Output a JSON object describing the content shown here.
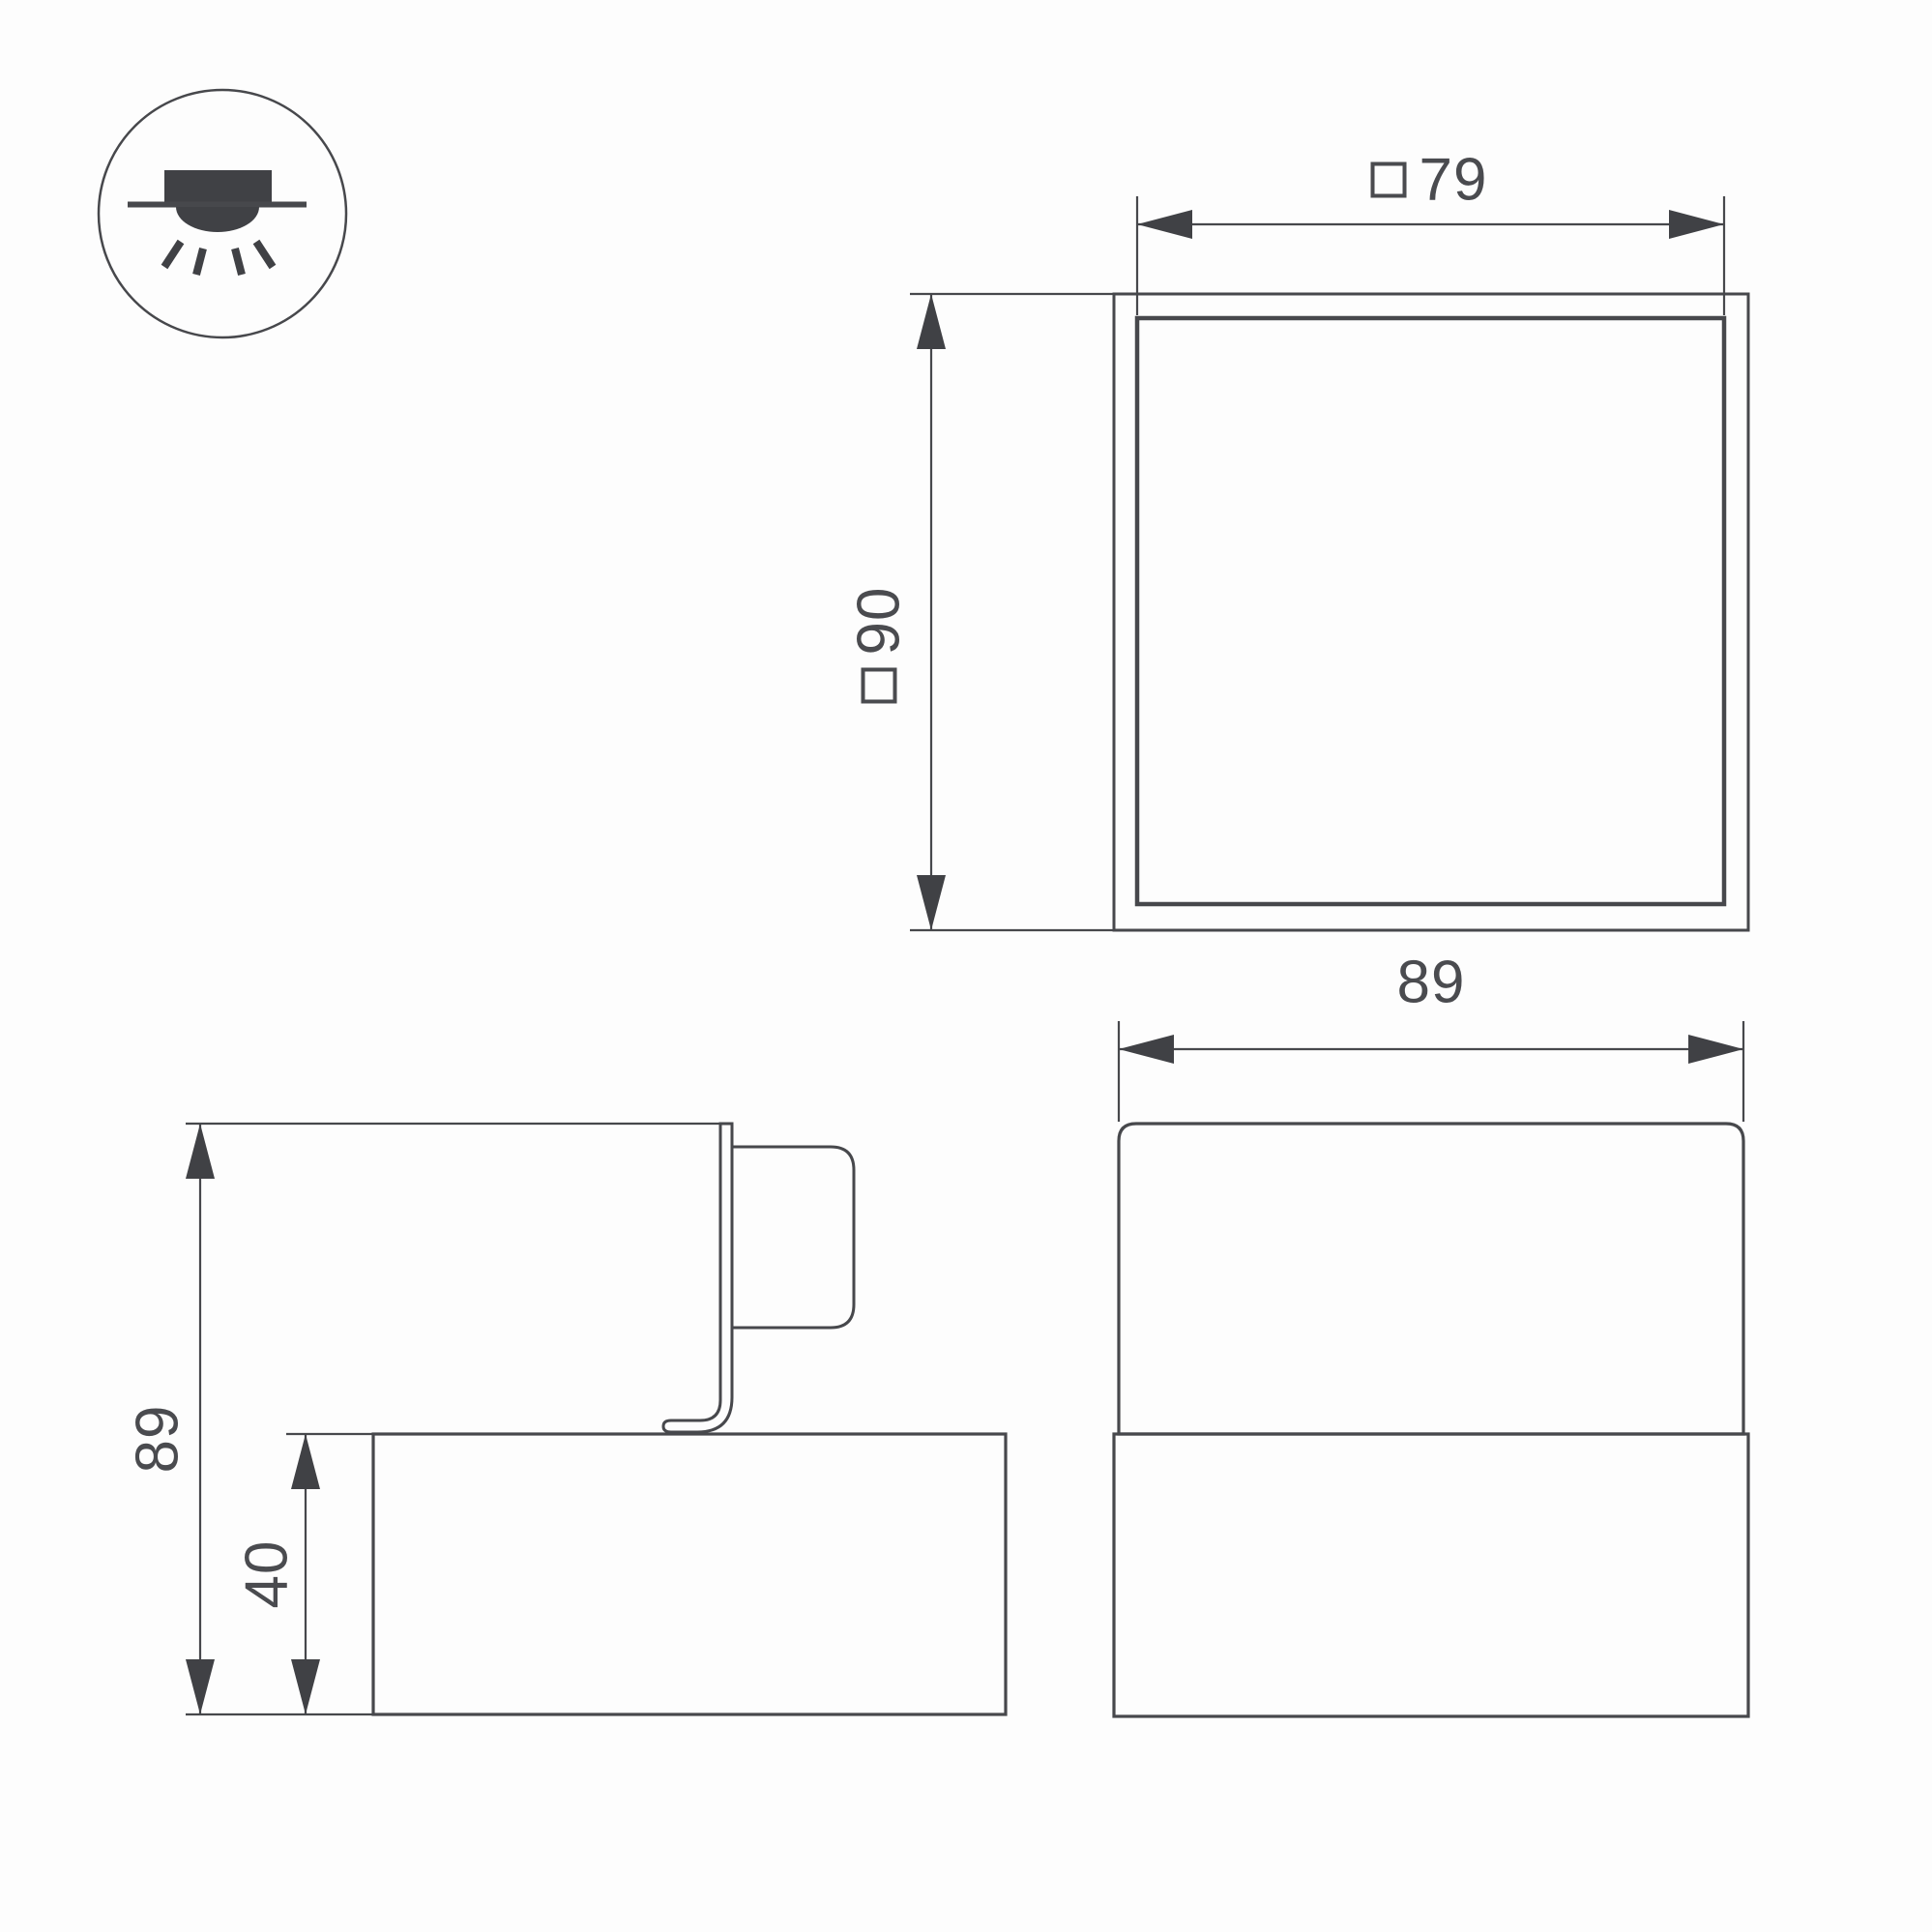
{
  "sheet": {
    "background": "#fdfdfd",
    "line_color": "#47484c",
    "text_color": "#4a4b4f"
  },
  "icons": {
    "legend": "surface-mounted-downlight-icon"
  },
  "top_view": {
    "width_dim_prefix": "□",
    "width_dim": "79",
    "height_dim_prefix": "□",
    "height_dim": "90"
  },
  "front_view": {
    "width_dim": "89"
  },
  "side_view": {
    "total_height_dim": "89",
    "base_height_dim": "40"
  }
}
